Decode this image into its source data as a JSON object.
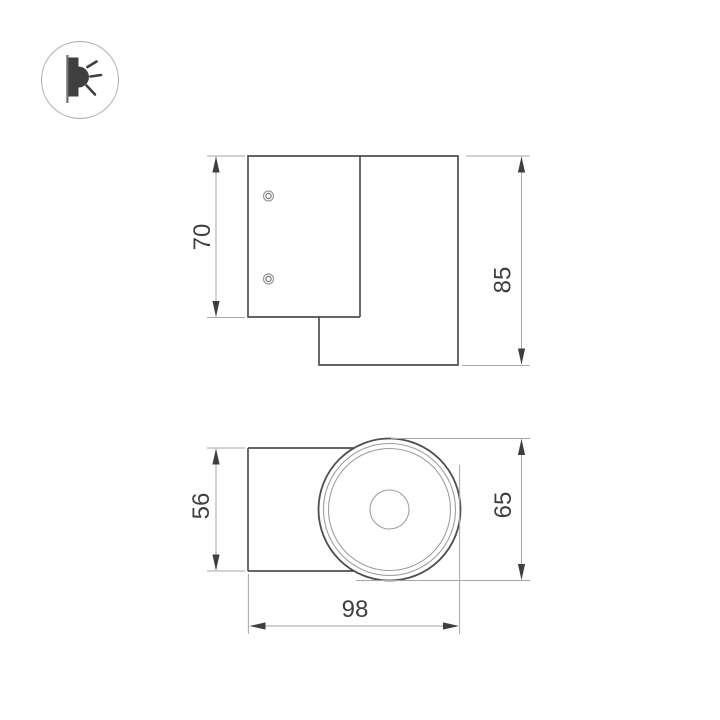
{
  "page": {
    "background": "#ffffff"
  },
  "emission_icon": {
    "name": "one-direction-light-emission"
  },
  "dimensions": {
    "side_view": {
      "plate_height": "70",
      "total_height": "85"
    },
    "top_view": {
      "body_depth": "56",
      "head_diameter": "65",
      "total_width": "98"
    }
  },
  "colors": {
    "object_line": "#4f4f4f",
    "thin_line": "#a6a6a6",
    "dim_text": "#3f3f3f",
    "icon_dark": "#3f3f3f",
    "icon_circle_border": "#b9b9b9"
  }
}
